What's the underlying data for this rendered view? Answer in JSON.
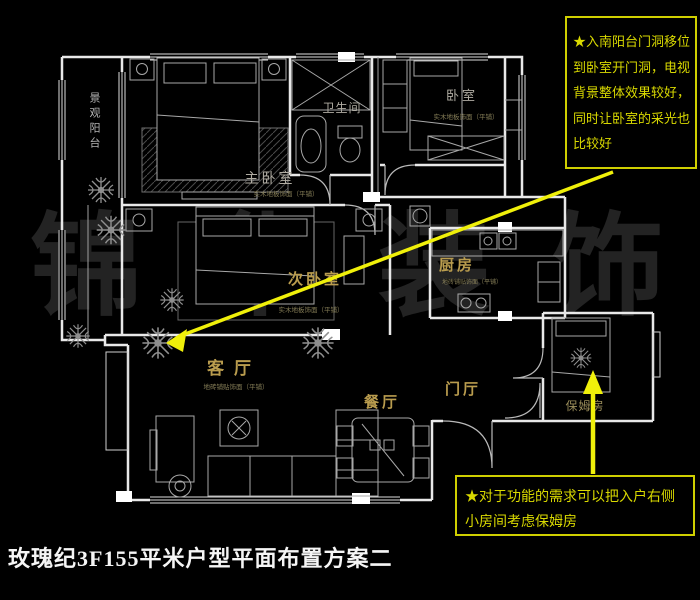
{
  "title": "玫瑰纪3F155平米户型平面布置方案二",
  "watermark": "锦华装饰",
  "annotations": {
    "top_note": "★入南阳台门洞移位到卧室开门洞，电视背景整体效果较好，同时让卧室的采光也比较好",
    "bottom_note": "★对于功能的需求可以把入户右侧小房间考虑保姆房"
  },
  "rooms": {
    "balcony": {
      "name": "景观阳台"
    },
    "master_bedroom": {
      "name": "主卧室",
      "floor_note": "实木地板饰面（平铺）"
    },
    "bathroom": {
      "name": "卫生间"
    },
    "bedroom": {
      "name": "卧室",
      "floor_note": "实木地板饰面（平铺）"
    },
    "second_bedroom": {
      "name": "次卧室",
      "floor_note": "实木地板饰面（平铺）"
    },
    "kitchen": {
      "name": "厨房",
      "floor_note": "地砖铺贴饰面（平铺）"
    },
    "living_room": {
      "name": "客厅",
      "floor_note": "地砖铺贴饰面（平铺）"
    },
    "dining_room": {
      "name": "餐厅"
    },
    "foyer": {
      "name": "门厅"
    },
    "nanny_room": {
      "name": "保姆房"
    }
  },
  "colors": {
    "background": "#000000",
    "wall_line": "#e8e8e8",
    "furniture_line": "#9a9a9a",
    "gold_label": "#b99c4e",
    "gray_label": "#b0aca2",
    "annotation_yellow": "#d9d900",
    "arrow_yellow": "#f0f00a",
    "watermark_gray": "rgba(235,235,235,0.15)"
  }
}
